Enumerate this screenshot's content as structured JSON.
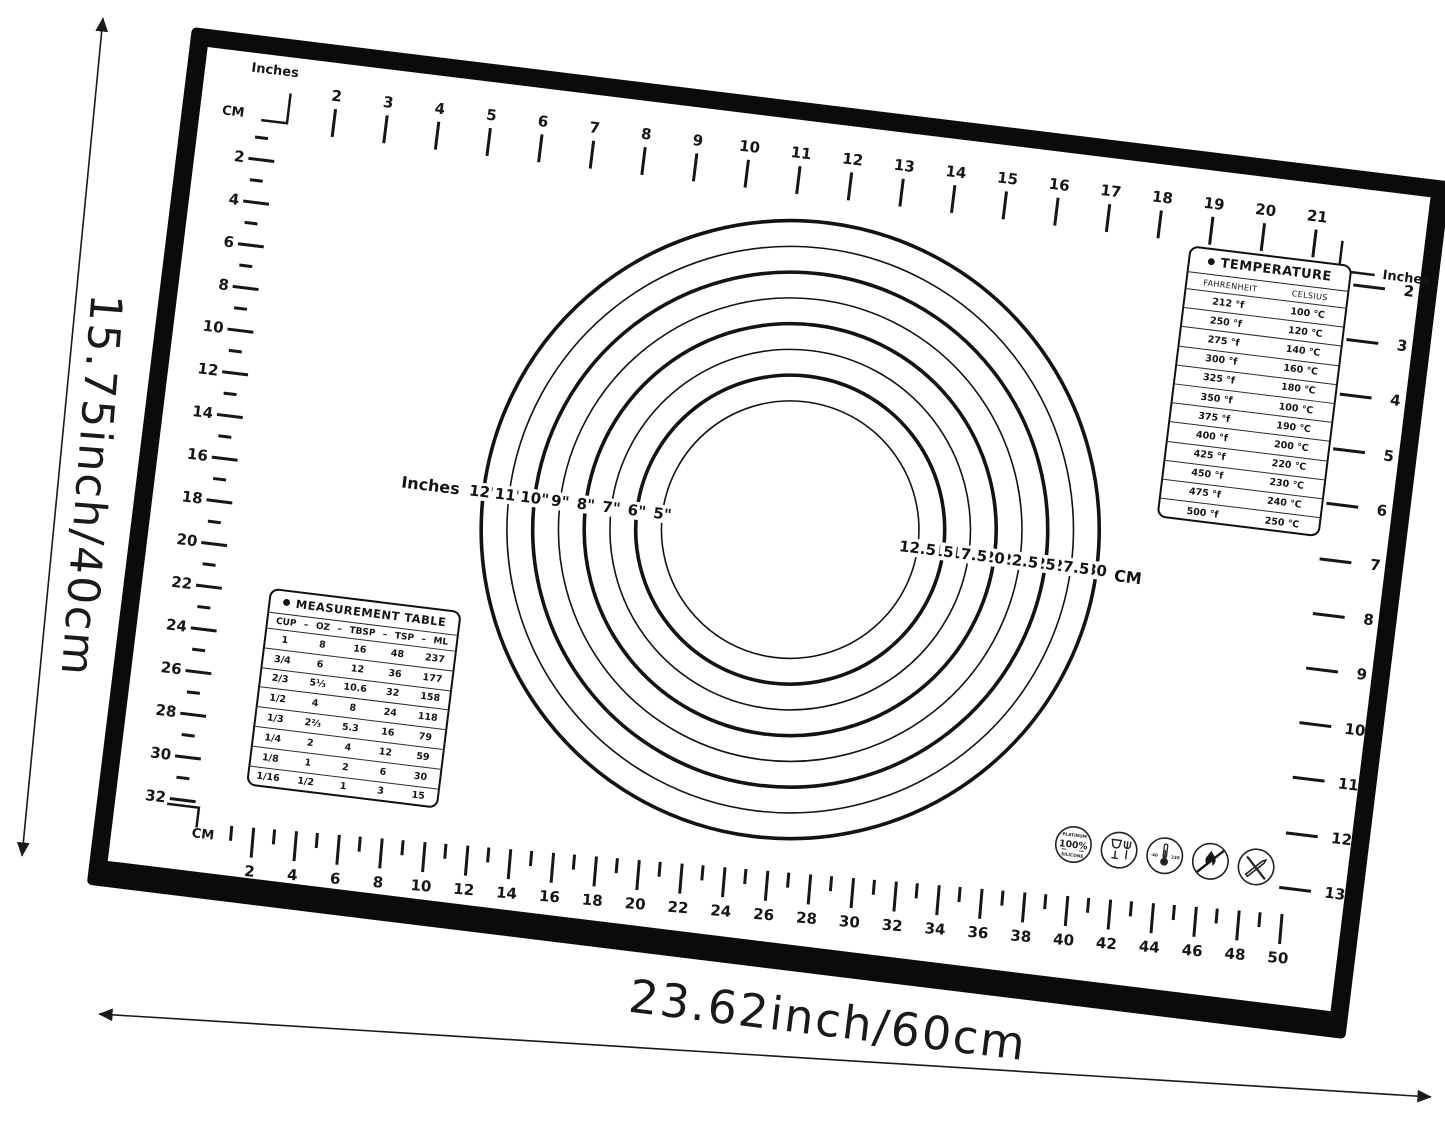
{
  "dimension_labels": {
    "height": "15.75inch/40cm",
    "width": "23.62inch/60cm"
  },
  "mat": {
    "corner_labels": {
      "top_left_unit_inches": "Inches",
      "top_left_unit_cm": "CM",
      "top_right_unit_inches": "Inches",
      "bottom_left_unit_cm": "CM"
    },
    "rulers": {
      "top_inches": [
        2,
        3,
        4,
        5,
        6,
        7,
        8,
        9,
        10,
        11,
        12,
        13,
        14,
        15,
        16,
        17,
        18,
        19,
        20,
        21
      ],
      "left_cm": [
        2,
        4,
        6,
        8,
        10,
        12,
        14,
        16,
        18,
        20,
        22,
        24,
        26,
        28,
        30,
        32
      ],
      "bottom_cm": [
        2,
        4,
        6,
        8,
        10,
        12,
        14,
        16,
        18,
        20,
        22,
        24,
        26,
        28,
        30,
        32,
        34,
        36,
        38,
        40,
        42,
        44,
        46,
        48,
        50
      ],
      "right_inches": [
        2,
        3,
        4,
        5,
        6,
        7,
        8,
        9,
        10,
        11,
        12,
        13
      ]
    },
    "circle_guide": {
      "left_unit_label": "Inches",
      "right_unit_label": "CM",
      "rings": [
        {
          "inches": "12\"",
          "cm": "30",
          "diameter_cm": 30,
          "thick": true
        },
        {
          "inches": "11\"",
          "cm": "27.5",
          "diameter_cm": 27.5,
          "thick": false
        },
        {
          "inches": "10\"",
          "cm": "25",
          "diameter_cm": 25,
          "thick": true
        },
        {
          "inches": "9\"",
          "cm": "22.5",
          "diameter_cm": 22.5,
          "thick": false
        },
        {
          "inches": "8\"",
          "cm": "20",
          "diameter_cm": 20,
          "thick": true
        },
        {
          "inches": "7\"",
          "cm": "17.5",
          "diameter_cm": 17.5,
          "thick": false
        },
        {
          "inches": "6\"",
          "cm": "15",
          "diameter_cm": 15,
          "thick": true
        },
        {
          "inches": "5\"",
          "cm": "12.5",
          "diameter_cm": 12.5,
          "thick": false
        }
      ]
    },
    "temperature_table": {
      "bullet": "●",
      "title": "TEMPERATURE",
      "columns": [
        "FAHRENHEIT",
        "CELSIUS"
      ],
      "rows": [
        [
          "212 °f",
          "100 ℃"
        ],
        [
          "250 °f",
          "120 ℃"
        ],
        [
          "275 °f",
          "140 ℃"
        ],
        [
          "300 °f",
          "160 ℃"
        ],
        [
          "325 °f",
          "180 ℃"
        ],
        [
          "350 °f",
          "100 ℃"
        ],
        [
          "375 °f",
          "190 ℃"
        ],
        [
          "400 °f",
          "200 ℃"
        ],
        [
          "425 °f",
          "220 ℃"
        ],
        [
          "450 °f",
          "230 ℃"
        ],
        [
          "475 °f",
          "240 ℃"
        ],
        [
          "500 °f",
          "250 ℃"
        ]
      ]
    },
    "measurement_table": {
      "bullet": "●",
      "title": "MEASUREMENT TABLE",
      "separator": "–",
      "columns": [
        "CUP",
        "OZ",
        "TBSP",
        "TSP",
        "ML"
      ],
      "rows": [
        [
          "1",
          "8",
          "16",
          "48",
          "237"
        ],
        [
          "3/4",
          "6",
          "12",
          "36",
          "177"
        ],
        [
          "2/3",
          "5⅓",
          "10.6",
          "32",
          "158"
        ],
        [
          "1/2",
          "4",
          "8",
          "24",
          "118"
        ],
        [
          "1/3",
          "2⅔",
          "5.3",
          "16",
          "79"
        ],
        [
          "1/4",
          "2",
          "4",
          "12",
          "59"
        ],
        [
          "1/8",
          "1",
          "2",
          "6",
          "30"
        ],
        [
          "1/16",
          "1/2",
          "1",
          "3",
          "15"
        ]
      ]
    },
    "certification_icons": [
      {
        "name": "platinum-silicone-badge-icon",
        "text_top": "PLATINUM",
        "text_center": "100%",
        "text_bottom": "SILICONE"
      },
      {
        "name": "food-safe-icon"
      },
      {
        "name": "temperature-range-icon",
        "text_left": "-40",
        "text_right": "230"
      },
      {
        "name": "no-flame-icon"
      },
      {
        "name": "no-knife-icon"
      }
    ]
  }
}
